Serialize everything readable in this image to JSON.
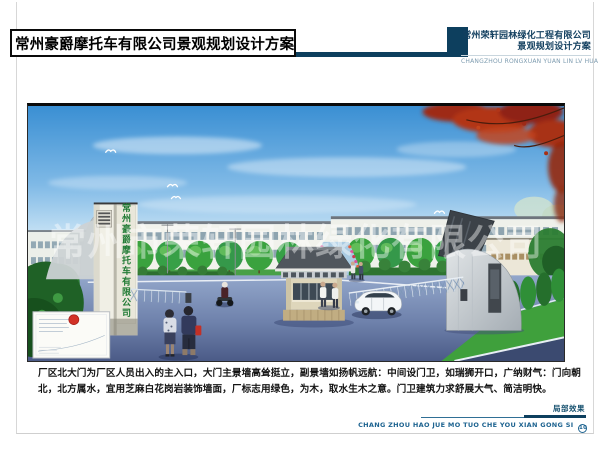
{
  "header": {
    "title": "常州豪爵摩托车有限公司景观规划设计方案",
    "company_name": "常州荣轩园林绿化工程有限公司",
    "company_subtitle": "景观规划设计方案",
    "company_pinyin": "CHANGZHOU RONGXUAN YUAN LIN LV HUA"
  },
  "rendering": {
    "factory_sign_vertical": "常州豪爵摩托车有限公司",
    "watermark": "常州市荣轩园林绿化有限公司"
  },
  "description": "厂区北大门为厂区人员出入的主入口，大门主景墙高耸挺立，副景墙如扬帆远航：中间设门卫，如瑞狮开口，广纳财气：门向朝北，北方属水，宜用芝麻白花岗岩装饰墙面，厂标志用绿色，为木，取水生木之意。门卫建筑力求舒展大气、简洁明快。",
  "footer": {
    "label": "局部效果",
    "pinyin": "CHANG ZHOU HAO JUE MO TUO CHE YOU XIAN GONG SI",
    "page_number": "10"
  },
  "colors": {
    "accent_navy": "#0d3f5e",
    "pinyin_blue": "#1d6390",
    "sign_green": "#1f7a33",
    "sky_blue": "#3a8fd3",
    "maple_red": "#a83014",
    "stamp_red": "#d23126"
  }
}
